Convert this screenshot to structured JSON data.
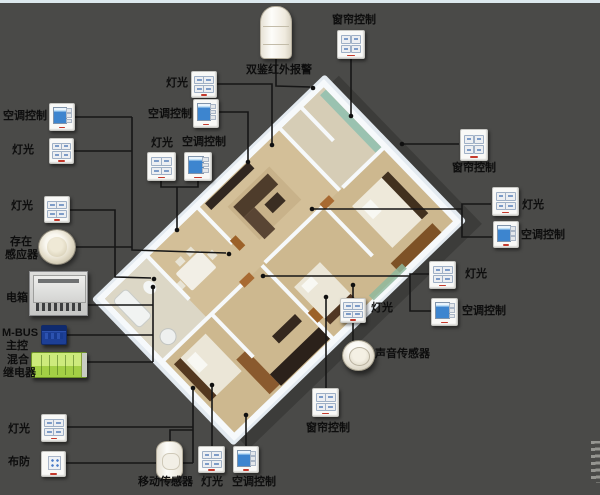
{
  "meta": {
    "width": 600,
    "height": 495
  },
  "colors": {
    "background": "#4a4a48",
    "top_strip": "#dde9ee",
    "wire": "#161616",
    "label_text": "#0d0d0d",
    "switch_face": "#f9f9f7",
    "switch_brand_red": "#c4392c",
    "ac_screen_blue": "#3d85cf",
    "mbus_blue": "#1d3f96",
    "relay_green": "#a3cf45",
    "plan_wall_white": "#f6f9fb",
    "plan_floor_tan": "#cdb88f",
    "plan_platform": "#e3eaf0",
    "glass_green": "#9ac2b0"
  },
  "devices": [
    {
      "id": "ac-switch-top-left",
      "type": "ac",
      "x": 49,
      "y": 103,
      "w": 26,
      "h": 28,
      "labels": [
        {
          "text": "空调控制",
          "x": 3,
          "y": 110
        }
      ]
    },
    {
      "id": "light-switch-top-left",
      "type": "sw4",
      "x": 49,
      "y": 138,
      "w": 25,
      "h": 26,
      "labels": [
        {
          "text": "灯光",
          "x": 12,
          "y": 144
        }
      ]
    },
    {
      "id": "light-switch-left",
      "type": "sw4",
      "x": 44,
      "y": 196,
      "w": 26,
      "h": 27,
      "labels": [
        {
          "text": "灯光",
          "x": 11,
          "y": 200
        }
      ]
    },
    {
      "id": "presence-sensor",
      "type": "dome",
      "x": 38,
      "y": 229,
      "w": 38,
      "h": 36,
      "labels": [
        {
          "text": "存在",
          "x": 10,
          "y": 236
        },
        {
          "text": "感应器",
          "x": 5,
          "y": 249
        }
      ]
    },
    {
      "id": "electric-box",
      "type": "ebox",
      "x": 29,
      "y": 271,
      "w": 59,
      "h": 45,
      "labels": [
        {
          "text": "电箱",
          "x": 6,
          "y": 292
        }
      ]
    },
    {
      "id": "mbus-controller",
      "type": "mbus",
      "x": 41,
      "y": 325,
      "w": 26,
      "h": 20,
      "labels": [
        {
          "text": "M-BUS",
          "x": 2,
          "y": 327
        },
        {
          "text": "主控",
          "x": 6,
          "y": 340
        }
      ]
    },
    {
      "id": "hybrid-relay",
      "type": "relay",
      "x": 31,
      "y": 352,
      "w": 56,
      "h": 26,
      "labels": [
        {
          "text": "混合",
          "x": 7,
          "y": 354
        },
        {
          "text": "继电器",
          "x": 3,
          "y": 367
        }
      ]
    },
    {
      "id": "light-switch-bottom-left",
      "type": "sw4",
      "x": 41,
      "y": 414,
      "w": 26,
      "h": 28,
      "labels": [
        {
          "text": "灯光",
          "x": 8,
          "y": 423
        }
      ]
    },
    {
      "id": "arm-panel",
      "type": "arm",
      "x": 41,
      "y": 451,
      "w": 25,
      "h": 26,
      "labels": [
        {
          "text": "布防",
          "x": 8,
          "y": 456
        }
      ]
    },
    {
      "id": "motion-sensor",
      "type": "motion",
      "x": 156,
      "y": 441,
      "w": 27,
      "h": 38,
      "labels": [
        {
          "text": "移动传感器",
          "x": 138,
          "y": 476
        }
      ]
    },
    {
      "id": "light-switch-bottom",
      "type": "sw4",
      "x": 198,
      "y": 446,
      "w": 27,
      "h": 27,
      "labels": [
        {
          "text": "灯光",
          "x": 201,
          "y": 476
        }
      ]
    },
    {
      "id": "ac-switch-bottom",
      "type": "ac",
      "x": 233,
      "y": 446,
      "w": 26,
      "h": 27,
      "labels": [
        {
          "text": "空调控制",
          "x": 232,
          "y": 476
        }
      ]
    },
    {
      "id": "curtain-switch-bottom",
      "type": "sw4",
      "x": 312,
      "y": 388,
      "w": 27,
      "h": 29,
      "labels": [
        {
          "text": "窗帘控制",
          "x": 306,
          "y": 422
        }
      ]
    },
    {
      "id": "sound-sensor",
      "type": "sound",
      "x": 342,
      "y": 340,
      "w": 33,
      "h": 31,
      "labels": [
        {
          "text": "声音传感器",
          "x": 375,
          "y": 348
        }
      ]
    },
    {
      "id": "light-switch-mid",
      "type": "sw4",
      "x": 340,
      "y": 298,
      "w": 26,
      "h": 25,
      "labels": [
        {
          "text": "灯光",
          "x": 371,
          "y": 302
        }
      ]
    },
    {
      "id": "infrared-alarm",
      "type": "pir",
      "x": 260,
      "y": 6,
      "w": 32,
      "h": 53,
      "labels": [
        {
          "text": "双鉴红外报警",
          "x": 246,
          "y": 64
        }
      ]
    },
    {
      "id": "curtain-switch-top",
      "type": "sw4",
      "x": 337,
      "y": 30,
      "w": 28,
      "h": 29,
      "labels": [
        {
          "text": "窗帘控制",
          "x": 332,
          "y": 14
        }
      ]
    },
    {
      "id": "light-switch-top-1",
      "type": "sw4",
      "x": 191,
      "y": 71,
      "w": 26,
      "h": 27,
      "labels": [
        {
          "text": "灯光",
          "x": 166,
          "y": 77
        }
      ]
    },
    {
      "id": "ac-switch-top-1",
      "type": "ac",
      "x": 193,
      "y": 99,
      "w": 26,
      "h": 29,
      "labels": [
        {
          "text": "空调控制",
          "x": 148,
          "y": 108
        }
      ]
    },
    {
      "id": "light-switch-top-2",
      "type": "sw4",
      "x": 147,
      "y": 152,
      "w": 29,
      "h": 29,
      "labels": [
        {
          "text": "灯光",
          "x": 151,
          "y": 137
        }
      ]
    },
    {
      "id": "ac-switch-top-2",
      "type": "ac",
      "x": 184,
      "y": 152,
      "w": 28,
      "h": 29,
      "labels": [
        {
          "text": "空调控制",
          "x": 182,
          "y": 136
        }
      ]
    },
    {
      "id": "curtain-switch-top-right",
      "type": "sw4",
      "x": 460,
      "y": 129,
      "w": 28,
      "h": 32,
      "labels": [
        {
          "text": "窗帘控制",
          "x": 452,
          "y": 162
        }
      ]
    },
    {
      "id": "light-switch-right-1",
      "type": "sw4",
      "x": 492,
      "y": 187,
      "w": 27,
      "h": 29,
      "labels": [
        {
          "text": "灯光",
          "x": 522,
          "y": 199
        }
      ]
    },
    {
      "id": "ac-switch-right-1",
      "type": "ac",
      "x": 493,
      "y": 221,
      "w": 26,
      "h": 27,
      "labels": [
        {
          "text": "空调控制",
          "x": 521,
          "y": 229
        }
      ]
    },
    {
      "id": "light-switch-right-2",
      "type": "sw4",
      "x": 429,
      "y": 261,
      "w": 27,
      "h": 28,
      "labels": [
        {
          "text": "灯光",
          "x": 465,
          "y": 268
        }
      ]
    },
    {
      "id": "ac-switch-right-2",
      "type": "ac",
      "x": 431,
      "y": 298,
      "w": 27,
      "h": 28,
      "labels": [
        {
          "text": "空调控制",
          "x": 462,
          "y": 305
        }
      ]
    }
  ],
  "wires": [
    {
      "pts": [
        [
          75,
          117
        ],
        [
          132,
          117
        ]
      ]
    },
    {
      "pts": [
        [
          74,
          151
        ],
        [
          132,
          151
        ]
      ]
    },
    {
      "pts": [
        [
          132,
          117
        ],
        [
          132,
          250
        ],
        [
          226,
          253
        ]
      ],
      "dot": [
        229,
        254
      ]
    },
    {
      "pts": [
        [
          70,
          210
        ],
        [
          115,
          210
        ],
        [
          115,
          277
        ],
        [
          151,
          278
        ]
      ],
      "dot": [
        154,
        279
      ]
    },
    {
      "pts": [
        [
          76,
          247
        ],
        [
          132,
          247
        ]
      ]
    },
    {
      "pts": [
        [
          88,
          305
        ],
        [
          153,
          305
        ]
      ]
    },
    {
      "pts": [
        [
          67,
          335
        ],
        [
          153,
          335
        ]
      ]
    },
    {
      "pts": [
        [
          87,
          362
        ],
        [
          153,
          362
        ]
      ]
    },
    {
      "pts": [
        [
          153,
          362
        ],
        [
          153,
          289
        ]
      ],
      "dot": [
        153,
        287
      ]
    },
    {
      "pts": [
        [
          67,
          427
        ],
        [
          193,
          427
        ]
      ]
    },
    {
      "pts": [
        [
          66,
          463
        ],
        [
          193,
          463
        ]
      ]
    },
    {
      "pts": [
        [
          193,
          463
        ],
        [
          193,
          390
        ]
      ],
      "dot": [
        193,
        388
      ]
    },
    {
      "pts": [
        [
          170,
          441
        ],
        [
          170,
          430
        ],
        [
          193,
          430
        ]
      ]
    },
    {
      "pts": [
        [
          212,
          446
        ],
        [
          212,
          387
        ]
      ],
      "dot": [
        212,
        385
      ]
    },
    {
      "pts": [
        [
          246,
          446
        ],
        [
          246,
          417
        ]
      ],
      "dot": [
        246,
        415
      ]
    },
    {
      "pts": [
        [
          326,
          388
        ],
        [
          326,
          299
        ]
      ],
      "dot": [
        326,
        297
      ]
    },
    {
      "pts": [
        [
          353,
          298
        ],
        [
          353,
          287
        ]
      ],
      "dot": [
        353,
        285
      ]
    },
    {
      "pts": [
        [
          353,
          323
        ],
        [
          353,
          341
        ]
      ]
    },
    {
      "pts": [
        [
          161,
          181
        ],
        [
          161,
          187
        ],
        [
          198,
          187
        ],
        [
          198,
          181
        ]
      ]
    },
    {
      "pts": [
        [
          177,
          187
        ],
        [
          177,
          228
        ]
      ],
      "dot": [
        177,
        230
      ]
    },
    {
      "pts": [
        [
          219,
          112
        ],
        [
          248,
          112
        ],
        [
          248,
          160
        ]
      ],
      "dot": [
        248,
        162
      ]
    },
    {
      "pts": [
        [
          217,
          84
        ],
        [
          272,
          84
        ],
        [
          272,
          143
        ]
      ],
      "dot": [
        272,
        145
      ]
    },
    {
      "pts": [
        [
          276,
          59
        ],
        [
          276,
          86
        ],
        [
          310,
          87
        ]
      ],
      "dot": [
        313,
        88
      ]
    },
    {
      "pts": [
        [
          351,
          59
        ],
        [
          351,
          114
        ]
      ],
      "dot": [
        351,
        116
      ]
    },
    {
      "pts": [
        [
          459,
          144
        ],
        [
          404,
          144
        ]
      ],
      "dot": [
        402,
        144
      ]
    },
    {
      "pts": [
        [
          491,
          204
        ],
        [
          462,
          204
        ],
        [
          462,
          237
        ],
        [
          492,
          237
        ]
      ]
    },
    {
      "pts": [
        [
          462,
          209
        ],
        [
          314,
          209
        ]
      ],
      "dot": [
        312,
        209
      ]
    },
    {
      "pts": [
        [
          429,
          274
        ],
        [
          410,
          274
        ],
        [
          410,
          311
        ],
        [
          431,
          311
        ]
      ]
    },
    {
      "pts": [
        [
          410,
          276
        ],
        [
          265,
          276
        ]
      ],
      "dot": [
        263,
        276
      ]
    }
  ]
}
